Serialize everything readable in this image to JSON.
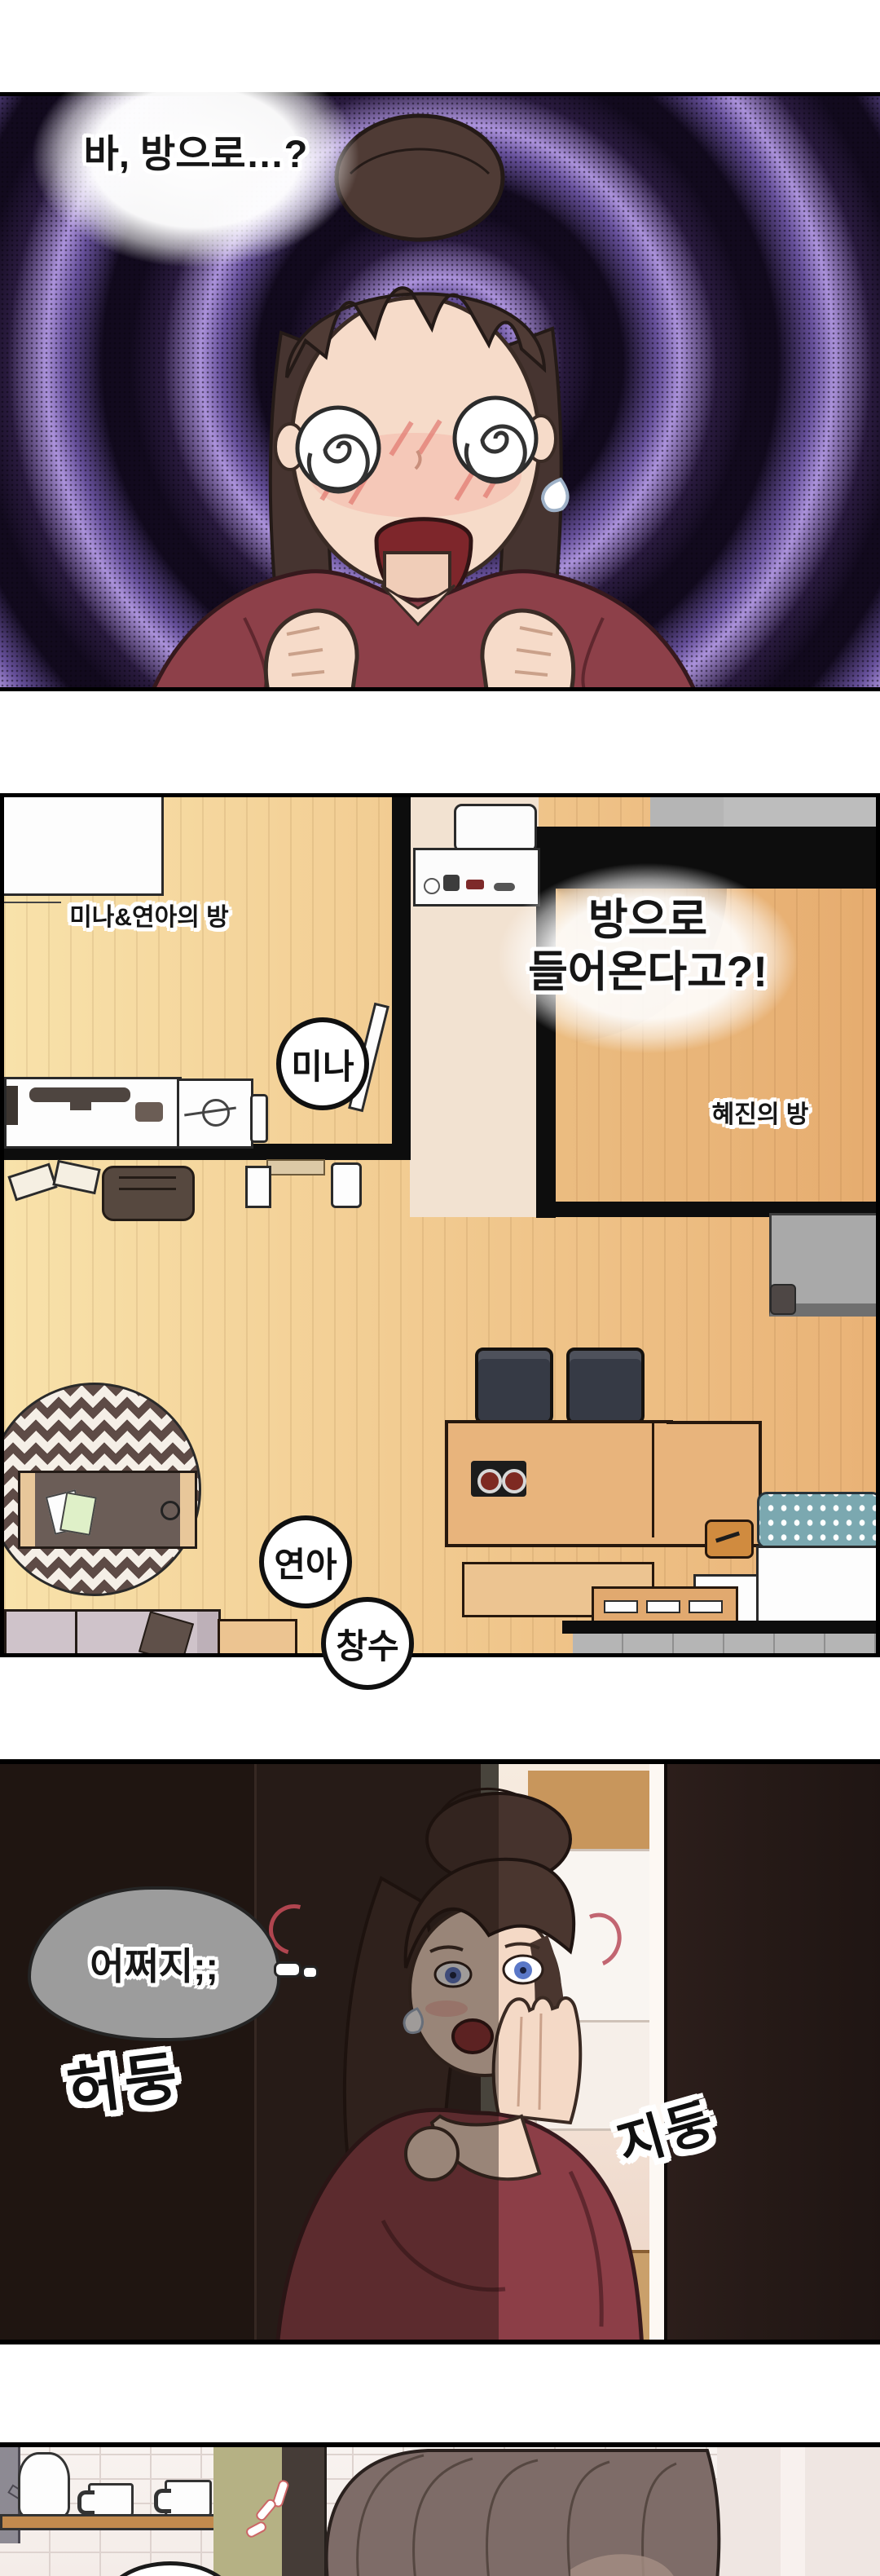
{
  "comic": {
    "panel1": {
      "speech_bubble": "바, 방으로…?"
    },
    "panel2": {
      "bubble_line1": "방으로",
      "bubble_line2": "들어온다고?!",
      "left_room_label": "미나&연아의 방",
      "right_room_label": "혜진의 방",
      "name_circles": [
        {
          "label": "미나"
        },
        {
          "label": "연아"
        },
        {
          "label": "창수"
        }
      ]
    },
    "panel3": {
      "thought_bubble": "어쩌지;;",
      "sfx_left": "허둥",
      "sfx_right": "지둥"
    },
    "colors": {
      "spiral_purple": "#ab92db",
      "panel1_bg": "#0d0716",
      "shirt_maroon": "#8d4049",
      "wood_floor": "#f2cc92",
      "wall_black": "#0d0d0d",
      "rug_brown": "#5e4b46",
      "panel3_bg": "#2f2320",
      "closet_light": "#f3e6da",
      "olive_wall": "#b5b184",
      "tile_white": "#f7f3f1"
    }
  }
}
